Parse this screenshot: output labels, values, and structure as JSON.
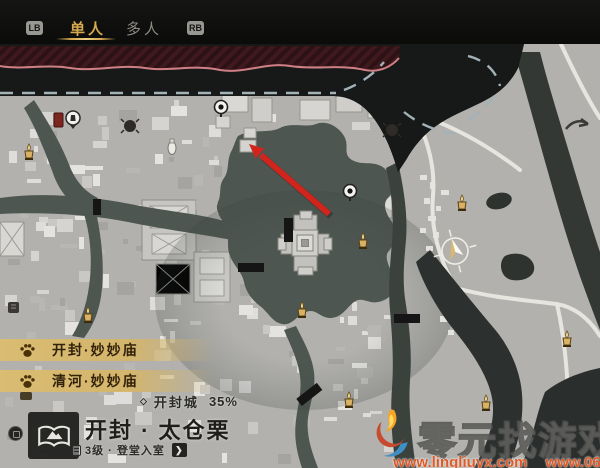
{
  "topbar": {
    "lb_label": "LB",
    "rb_label": "RB",
    "tab_single": "单人",
    "tab_multi": "多人"
  },
  "poi_list": {
    "items": [
      {
        "name": "开封·妙妙庙"
      },
      {
        "name": "清河·妙妙庙"
      }
    ]
  },
  "region": {
    "bullet": "◇",
    "name": "开封城",
    "progress": "35%"
  },
  "location": {
    "title": "开封 · 太仓栗",
    "level": "3级 · 登堂入室",
    "chevron": "❯"
  },
  "watermark": {
    "title": "零元找游戏",
    "url_left": "www.lingliuyx.com",
    "url_right": "www.06zyx.com"
  },
  "icons": {
    "incense_marker": "gold incense-burner map marker",
    "ring_pin": "white ring pin with black dot",
    "teleport_pin": "fast-travel circle pin",
    "player_compass": "player position compass with direction cone",
    "paw": "paw print",
    "map_badge": "scroll-and-mountain location emblem"
  },
  "colors": {
    "accent_gold": "#d5a94e",
    "poi_band": "#d8ba6e",
    "water": "#4d5651",
    "outside_zone_red": "#3f191d",
    "arrow_red": "#d0241c",
    "watermark_orange": "#dd5a28"
  }
}
